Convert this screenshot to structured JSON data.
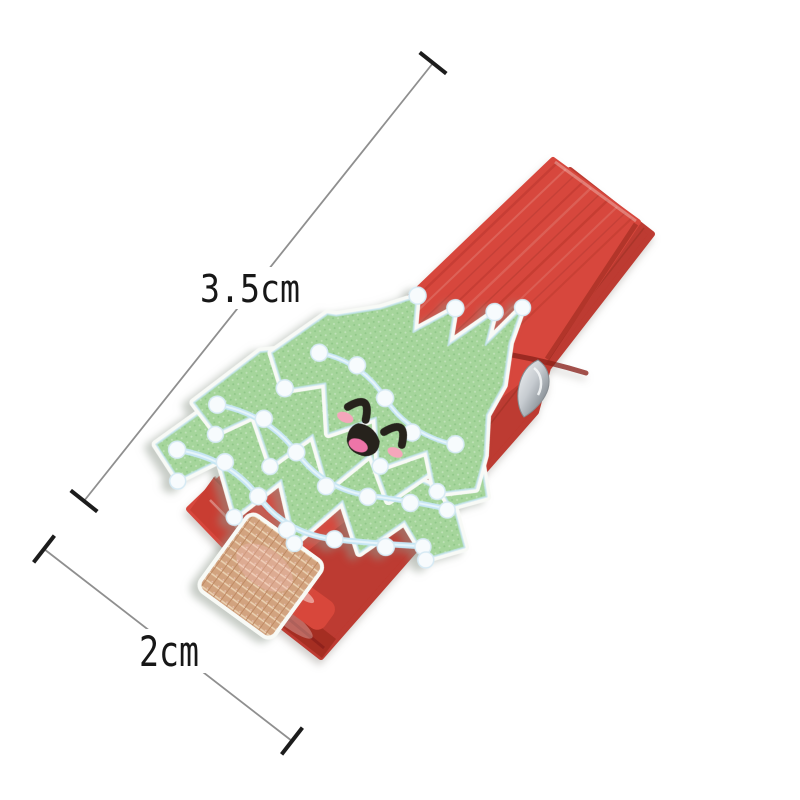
{
  "annotations": {
    "length_label": "3.5cm",
    "width_label": "2cm",
    "length_value_cm": 3.5,
    "width_value_cm": 2
  },
  "colors": {
    "background": "#ffffff",
    "dimension_line": "#8f8f8f",
    "dimension_tick": "#1c1c1c",
    "label_text": "#171717",
    "clip_red": "#d7473c",
    "clip_red_dark": "#bd3a30",
    "clip_red_deep": "#a32d23",
    "clip_red_bright": "#d8473a",
    "tree_green": "#a5d59b",
    "tree_outline": "#f8faf6",
    "garland_blue": "#c6e6f4",
    "light_dot": "#f7fbfd",
    "trunk_tan": "#d2a37f",
    "face_black": "#27221f",
    "tongue_pink": "#ee74a8",
    "cheek_pink": "#f5a6bb",
    "spring_silver": "#ccd1d5"
  }
}
